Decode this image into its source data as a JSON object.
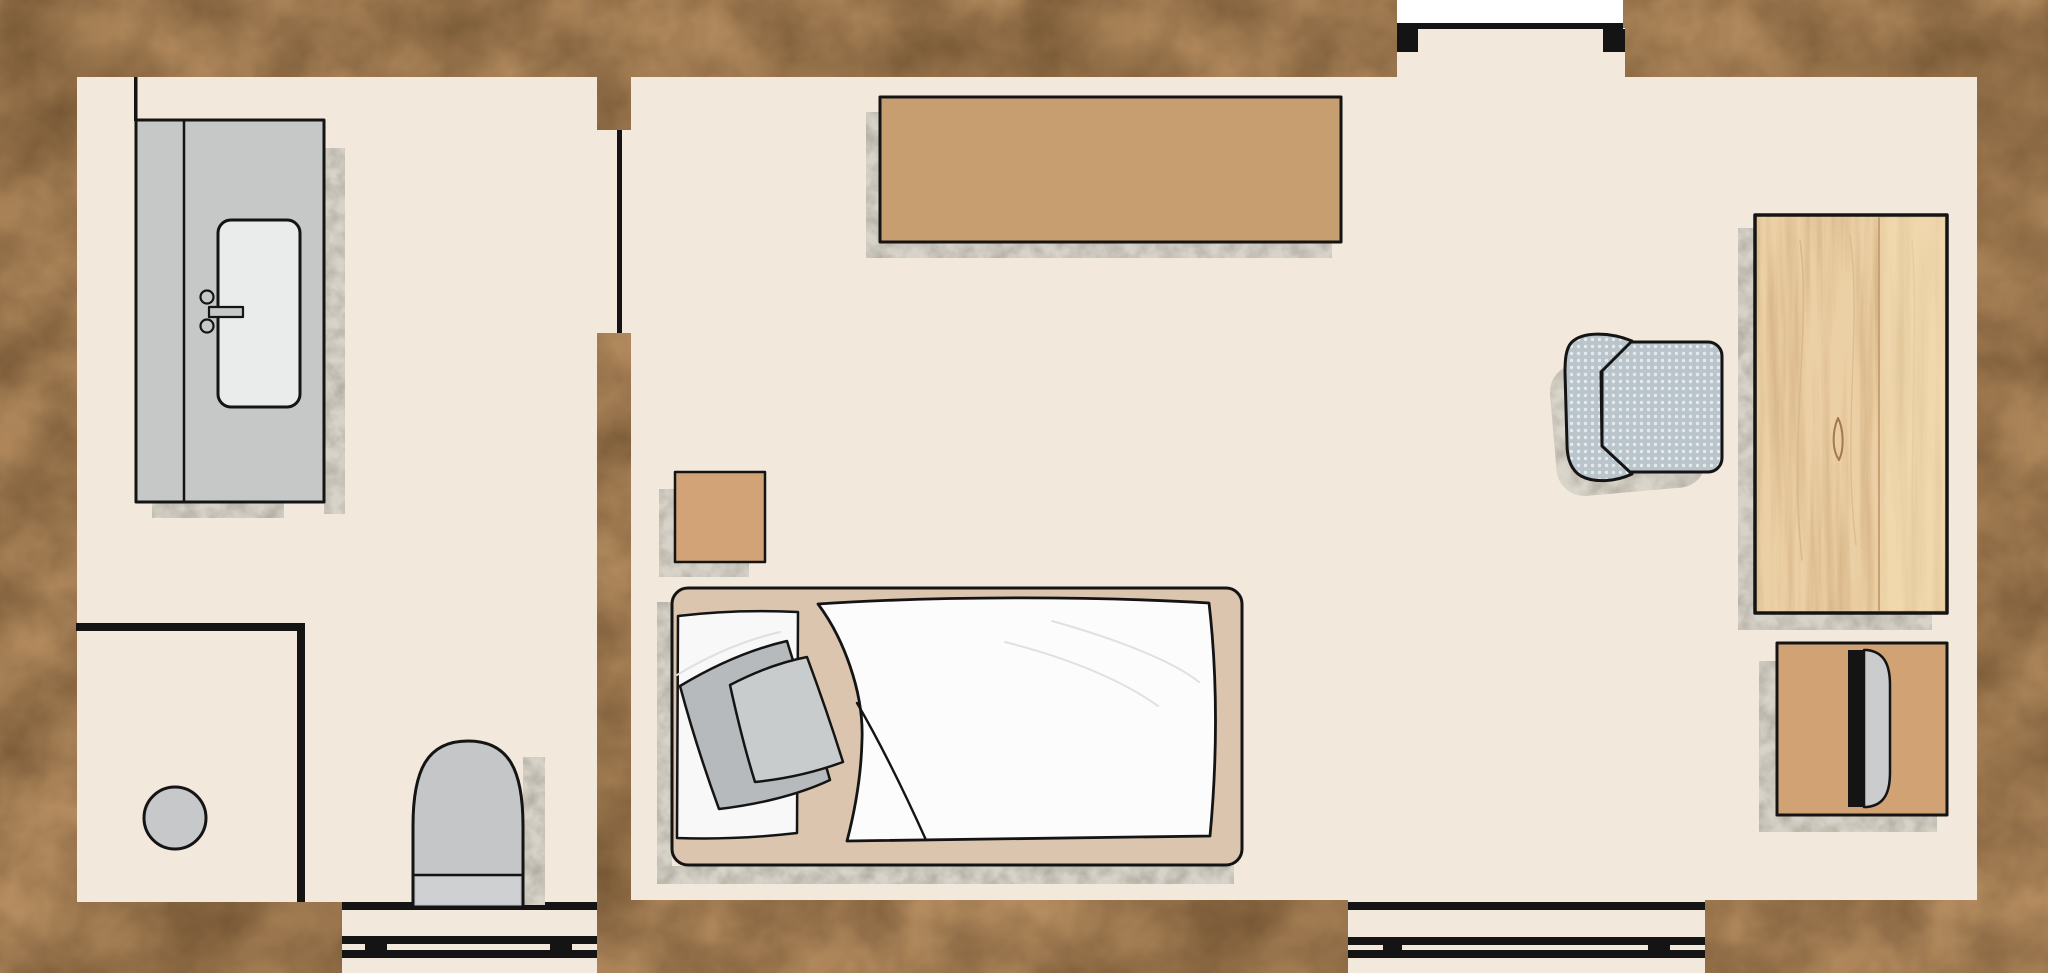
{
  "meta": {
    "title": "apartment-floor-plan",
    "canvas_width": 2048,
    "canvas_height": 973
  },
  "palette": {
    "floor": "#f2e8db",
    "line": "#141414",
    "stone_base": "#b58c5f",
    "concrete_base": "#d7d3c9",
    "wood_base": "#ecd0a5",
    "fabric_base": "#b9c4cb",
    "counter_gray": "#c6c7c7",
    "sink_white": "#eaeceb",
    "toilet_gray": "#c5c6c8",
    "tank_gray": "#ced0d1",
    "stool_gray": "#c6c8ca",
    "shelf_tan": "#c79e70",
    "nightstand_tan": "#d2a376",
    "dresser_tan": "#d1a274",
    "bed_frame_tan": "#dbc5af",
    "sheet_white": "#f8f8f9",
    "duvet_white": "#fcfcfd",
    "pillow_dark": "#b6babd",
    "pillow_light": "#c9cccd",
    "door_white": "#ffffff"
  },
  "scene": [
    {
      "name": "exterior-stone-ground",
      "kind": "rect",
      "x": 0,
      "y": 0,
      "w": 2048,
      "h": 973,
      "fill": "stone",
      "interactable": false
    },
    {
      "name": "bathroom-floor",
      "kind": "rect",
      "x": 77,
      "y": 77,
      "w": 520,
      "h": 825,
      "fill": "floor",
      "interactable": false
    },
    {
      "name": "bedroom-floor",
      "kind": "rect",
      "x": 631,
      "y": 77,
      "w": 1346,
      "h": 823,
      "fill": "floor",
      "interactable": false
    },
    {
      "name": "divider-doorway-floor",
      "kind": "rect",
      "x": 597,
      "y": 130,
      "w": 34,
      "h": 203,
      "fill": "floor",
      "interactable": false
    },
    {
      "name": "entry-doorway-recess-floor",
      "kind": "rect",
      "x": 1397,
      "y": 28,
      "w": 228,
      "h": 49,
      "fill": "floor",
      "interactable": false
    },
    {
      "name": "bathroom-window-bay-floor",
      "kind": "rect",
      "x": 342,
      "y": 902,
      "w": 255,
      "h": 71,
      "fill": "floor",
      "interactable": false
    },
    {
      "name": "bedroom-window-bay-floor",
      "kind": "rect",
      "x": 1348,
      "y": 900,
      "w": 357,
      "h": 73,
      "fill": "floor",
      "interactable": false
    },
    {
      "name": "entry-door-slab",
      "kind": "rect",
      "x": 1397,
      "y": 0,
      "w": 226,
      "h": 23,
      "fill": "white",
      "interactable": false
    },
    {
      "name": "entry-door-threshold",
      "kind": "rect",
      "x": 1397,
      "y": 23,
      "w": 226,
      "h": 6,
      "fill": "black",
      "interactable": false
    },
    {
      "name": "entry-door-jamb-left",
      "kind": "rect",
      "x": 1397,
      "y": 29,
      "w": 21,
      "h": 23,
      "fill": "black",
      "interactable": false
    },
    {
      "name": "entry-door-jamb-right",
      "kind": "rect",
      "x": 1603,
      "y": 29,
      "w": 22,
      "h": 23,
      "fill": "black",
      "interactable": false
    },
    {
      "name": "divider-door-leaf-line",
      "kind": "rect",
      "x": 617,
      "y": 130,
      "w": 5,
      "h": 203,
      "fill": "black",
      "interactable": false
    },
    {
      "name": "bathroom-wall-nib-line",
      "kind": "rect",
      "x": 134,
      "y": 77,
      "w": 3.5,
      "h": 44,
      "fill": "black",
      "interactable": false
    },
    {
      "name": "closet-partition-horizontal",
      "kind": "rect",
      "x": 76,
      "y": 623,
      "w": 229,
      "h": 8,
      "fill": "black",
      "interactable": false
    },
    {
      "name": "closet-partition-vertical",
      "kind": "rect",
      "x": 297,
      "y": 623,
      "w": 8,
      "h": 279,
      "fill": "black",
      "interactable": false
    },
    {
      "name": "bathroom-window-wall-line",
      "kind": "rect",
      "x": 342,
      "y": 902,
      "w": 255,
      "h": 8,
      "fill": "black",
      "interactable": false
    },
    {
      "name": "bathroom-window-outer-bar",
      "kind": "rect",
      "x": 342,
      "y": 936,
      "w": 255,
      "h": 8,
      "fill": "black",
      "interactable": false
    },
    {
      "name": "bathroom-window-inner-bar",
      "kind": "rect",
      "x": 342,
      "y": 950,
      "w": 255,
      "h": 8,
      "fill": "black",
      "interactable": false
    },
    {
      "name": "bathroom-window-mullion-left",
      "kind": "rect",
      "x": 365,
      "y": 936,
      "w": 22,
      "h": 22,
      "fill": "black",
      "interactable": false
    },
    {
      "name": "bathroom-window-mullion-right",
      "kind": "rect",
      "x": 550,
      "y": 936,
      "w": 22,
      "h": 22,
      "fill": "black",
      "interactable": false
    },
    {
      "name": "bedroom-window-wall-line",
      "kind": "rect",
      "x": 1348,
      "y": 902,
      "w": 357,
      "h": 8,
      "fill": "black",
      "interactable": false
    },
    {
      "name": "bedroom-window-outer-bar",
      "kind": "rect",
      "x": 1348,
      "y": 937,
      "w": 357,
      "h": 8,
      "fill": "black",
      "interactable": false
    },
    {
      "name": "bedroom-window-inner-bar",
      "kind": "rect",
      "x": 1348,
      "y": 950,
      "w": 357,
      "h": 8,
      "fill": "black",
      "interactable": false
    },
    {
      "name": "bedroom-window-mullion-left",
      "kind": "rect",
      "x": 1383,
      "y": 937,
      "w": 19,
      "h": 21,
      "fill": "black",
      "interactable": false
    },
    {
      "name": "bedroom-window-mullion-right",
      "kind": "rect",
      "x": 1648,
      "y": 937,
      "w": 22,
      "h": 21,
      "fill": "black",
      "interactable": false
    },
    {
      "name": "counter-shadow-right",
      "kind": "rect",
      "x": 324,
      "y": 148,
      "w": 21,
      "h": 366,
      "fill": "concrete",
      "interactable": false
    },
    {
      "name": "counter-shadow-bottom",
      "kind": "rect",
      "x": 152,
      "y": 503,
      "w": 132,
      "h": 15,
      "fill": "concrete",
      "interactable": false
    },
    {
      "name": "vanity-counter",
      "kind": "rect",
      "x": 136,
      "y": 120,
      "w": 188,
      "h": 382,
      "fill": "counter_gray",
      "stroke": "line",
      "sw": 3,
      "interactable": false
    },
    {
      "name": "vanity-counter-divider-line",
      "kind": "line",
      "x1": 184,
      "y1": 121,
      "x2": 184,
      "y2": 501,
      "stroke": "line",
      "sw": 2.5,
      "interactable": false
    },
    {
      "name": "sink-basin",
      "kind": "rect",
      "x": 218,
      "y": 220,
      "w": 82,
      "h": 187,
      "rx": 13,
      "fill": "sink_white",
      "stroke": "line",
      "sw": 3,
      "interactable": false
    },
    {
      "name": "faucet-spout-bar",
      "kind": "rect",
      "x": 209,
      "y": 307,
      "w": 34,
      "h": 10,
      "fill": "counter_gray",
      "stroke": "line",
      "sw": 2.2,
      "interactable": false
    },
    {
      "name": "faucet-handle-top",
      "kind": "circle",
      "cx": 207,
      "cy": 297,
      "r": 6.5,
      "fill": "counter_gray",
      "stroke": "line",
      "sw": 2.2,
      "interactable": false
    },
    {
      "name": "faucet-handle-bottom",
      "kind": "circle",
      "cx": 207,
      "cy": 326,
      "r": 6.5,
      "fill": "counter_gray",
      "stroke": "line",
      "sw": 2.2,
      "interactable": false
    },
    {
      "name": "toilet-shadow",
      "kind": "rect",
      "x": 523,
      "y": 757,
      "w": 22,
      "h": 148,
      "fill": "concrete",
      "interactable": false
    },
    {
      "name": "toilet-body",
      "kind": "path",
      "d": "M 413 907 L 413 826 C 413 770 427 741 468 741 C 509 741 523 770 523 826 L 523 907 Z",
      "fill": "toilet_gray",
      "stroke": "line",
      "sw": 3,
      "interactable": false
    },
    {
      "name": "toilet-tank",
      "kind": "rect",
      "x": 416,
      "y": 877,
      "w": 104,
      "h": 27,
      "fill": "tank_gray",
      "interactable": false
    },
    {
      "name": "toilet-tank-line",
      "kind": "line",
      "x1": 413,
      "y1": 875,
      "x2": 523,
      "y2": 875,
      "stroke": "line",
      "sw": 2.5,
      "interactable": false
    },
    {
      "name": "stool",
      "kind": "circle",
      "cx": 175,
      "cy": 818,
      "r": 31,
      "fill": "stool_gray",
      "stroke": "line",
      "sw": 3,
      "interactable": false
    },
    {
      "name": "sideboard-shadow-left",
      "kind": "rect",
      "x": 866,
      "y": 112,
      "w": 14,
      "h": 145,
      "fill": "concrete",
      "interactable": false
    },
    {
      "name": "sideboard-shadow-bottom",
      "kind": "rect",
      "x": 866,
      "y": 243,
      "w": 466,
      "h": 15,
      "fill": "concrete",
      "interactable": false
    },
    {
      "name": "sideboard",
      "kind": "rect",
      "x": 880,
      "y": 97,
      "w": 461,
      "h": 145,
      "fill": "shelf_tan",
      "stroke": "line",
      "sw": 3,
      "interactable": false
    },
    {
      "name": "nightstand-shadow-left",
      "kind": "rect",
      "x": 659,
      "y": 489,
      "w": 16,
      "h": 88,
      "fill": "concrete",
      "interactable": false
    },
    {
      "name": "nightstand-shadow-bottom",
      "kind": "rect",
      "x": 659,
      "y": 563,
      "w": 90,
      "h": 14,
      "fill": "concrete",
      "interactable": false
    },
    {
      "name": "nightstand",
      "kind": "rect",
      "x": 675,
      "y": 472,
      "w": 90,
      "h": 90,
      "fill": "nightstand_tan",
      "stroke": "line",
      "sw": 2.5,
      "interactable": false
    },
    {
      "name": "bed-shadow-left",
      "kind": "rect",
      "x": 657,
      "y": 602,
      "w": 15,
      "h": 275,
      "fill": "concrete",
      "interactable": false
    },
    {
      "name": "bed-shadow-bottom",
      "kind": "rect",
      "x": 657,
      "y": 866,
      "w": 577,
      "h": 18,
      "fill": "concrete",
      "interactable": false
    },
    {
      "name": "bed-frame",
      "kind": "rect",
      "x": 672,
      "y": 588,
      "w": 570,
      "h": 277,
      "rx": 16,
      "fill": "bed_frame_tan",
      "stroke": "line",
      "sw": 3,
      "interactable": false
    },
    {
      "name": "bed-sheet",
      "kind": "path",
      "d": "M 678 616 Q 735 609 798 612 L 797 833 Q 737 840 677 838 Z",
      "fill": "sheet_white",
      "stroke": "line",
      "sw": 2.5,
      "interactable": false
    },
    {
      "name": "bed-sheet-crease",
      "kind": "path",
      "d": "M 677 675 C 710 655 745 640 780 632",
      "fill": "none",
      "stroke": "#dfdfe2",
      "sw": 2,
      "interactable": false
    },
    {
      "name": "duvet",
      "kind": "path",
      "d": "M 818 604 C 940 596 1090 596 1209 603 C 1218 680 1217 762 1210 836 L 847 841 C 853 818 861 783 862 740 C 864 692 843 637 818 604 Z",
      "fill": "duvet_white",
      "stroke": "line",
      "sw": 2.8,
      "interactable": false
    },
    {
      "name": "duvet-fold-line",
      "kind": "path",
      "d": "M 857 703 C 882 746 908 800 926 840",
      "fill": "none",
      "stroke": "line",
      "sw": 2.4,
      "interactable": false
    },
    {
      "name": "duvet-crease-1",
      "kind": "path",
      "d": "M 1005 642 C 1068 658 1122 680 1158 706",
      "fill": "none",
      "stroke": "#e0e0e3",
      "sw": 2,
      "interactable": false
    },
    {
      "name": "duvet-crease-2",
      "kind": "path",
      "d": "M 1052 621 C 1120 640 1174 662 1199 682",
      "fill": "none",
      "stroke": "#e0e0e3",
      "sw": 2,
      "interactable": false
    },
    {
      "name": "pillow-back",
      "kind": "path",
      "d": "M 680 686 C 715 665 752 649 787 641 C 801 687 817 734 830 780 C 796 796 754 805 719 809 C 704 768 691 727 680 686 Z",
      "fill": "pillow_dark",
      "stroke": "line",
      "sw": 2.5,
      "interactable": false
    },
    {
      "name": "pillow-front",
      "kind": "path",
      "d": "M 730 685 C 755 672 781 662 807 657 C 820 692 832 727 843 762 C 816 772 785 779 755 782 C 745 750 737 717 730 685 Z",
      "fill": "pillow_light",
      "stroke": "line",
      "sw": 2.5,
      "interactable": false
    },
    {
      "name": "desk-shadow-left",
      "kind": "rect",
      "x": 1738,
      "y": 228,
      "w": 17,
      "h": 400,
      "fill": "concrete",
      "interactable": false
    },
    {
      "name": "desk-shadow-bottom",
      "kind": "rect",
      "x": 1738,
      "y": 613,
      "w": 194,
      "h": 17,
      "fill": "concrete",
      "interactable": false
    },
    {
      "name": "desk",
      "kind": "rect",
      "x": 1755,
      "y": 215,
      "w": 192,
      "h": 398,
      "fill": "wood",
      "stroke": "line",
      "sw": 3.5,
      "interactable": false
    },
    {
      "name": "desk-plank-light",
      "kind": "rect",
      "x": 1880,
      "y": 218,
      "w": 64,
      "h": 392,
      "fill": "#f3ddb3",
      "opacity": 0.5,
      "interactable": false
    },
    {
      "name": "desk-plank-seam",
      "kind": "line",
      "x1": 1879,
      "y1": 218,
      "x2": 1879,
      "y2": 610,
      "stroke": "#c7a171",
      "sw": 2,
      "interactable": false
    },
    {
      "name": "desk-grain-1",
      "kind": "path",
      "d": "M 1800 240 C 1812 330 1788 430 1802 560",
      "fill": "none",
      "stroke": "#d9b987",
      "sw": 1.6,
      "interactable": false
    },
    {
      "name": "desk-grain-2",
      "kind": "path",
      "d": "M 1850 235 C 1862 330 1842 430 1856 545",
      "fill": "none",
      "stroke": "#ddbd8c",
      "sw": 1.4,
      "interactable": false
    },
    {
      "name": "desk-grain-3",
      "kind": "path",
      "d": "M 1912 240 C 1920 340 1906 470 1916 590",
      "fill": "none",
      "stroke": "#e6cda0",
      "sw": 1.4,
      "interactable": false
    },
    {
      "name": "desk-wood-knot",
      "kind": "path",
      "d": "M 1838 418 C 1832 432 1832 450 1839 460 C 1844 450 1844 430 1838 418 Z",
      "fill": "none",
      "stroke": "#a5794a",
      "sw": 2,
      "interactable": false
    },
    {
      "name": "chair-shadow",
      "kind": "rect",
      "x": 1553,
      "y": 360,
      "w": 150,
      "h": 132,
      "rx": 28,
      "fill": "concrete",
      "opacity": 0.9,
      "transform": "rotate(-5 1628 426)",
      "interactable": false
    },
    {
      "name": "office-chair-seat",
      "kind": "rect",
      "x": 1602,
      "y": 342,
      "w": 120,
      "h": 130,
      "rx": 14,
      "fill": "fabric",
      "stroke": "line",
      "sw": 3,
      "interactable": false
    },
    {
      "name": "office-chair-backrest",
      "kind": "path",
      "d": "M 1632 341 C 1610 332 1582 331 1571 343 C 1566 349 1565 359 1565 372 L 1567 444 C 1567 459 1571 470 1581 476 C 1594 483 1615 482 1632 474 L 1602 446 L 1601 372 Z",
      "fill": "fabric",
      "stroke": "line",
      "sw": 3,
      "interactable": false
    },
    {
      "name": "dresser-shadow-left",
      "kind": "rect",
      "x": 1759,
      "y": 661,
      "w": 18,
      "h": 169,
      "fill": "concrete",
      "interactable": false
    },
    {
      "name": "dresser-shadow-bottom",
      "kind": "rect",
      "x": 1759,
      "y": 815,
      "w": 178,
      "h": 17,
      "fill": "concrete",
      "interactable": false
    },
    {
      "name": "dresser",
      "kind": "rect",
      "x": 1777,
      "y": 643,
      "w": 170,
      "h": 172,
      "fill": "dresser_tan",
      "stroke": "line",
      "sw": 3,
      "interactable": false
    },
    {
      "name": "dresser-groove-bar",
      "kind": "rect",
      "x": 1848,
      "y": 650,
      "w": 16,
      "h": 157,
      "fill": "black",
      "interactable": false
    },
    {
      "name": "dresser-door-pull",
      "kind": "path",
      "d": "M 1864 650 L 1867 650 C 1886 652 1890 668 1890 685 L 1890 772 C 1890 790 1886 805 1867 807 L 1864 807 Z",
      "fill": "#caccce",
      "stroke": "line",
      "sw": 2.5,
      "interactable": false
    }
  ]
}
